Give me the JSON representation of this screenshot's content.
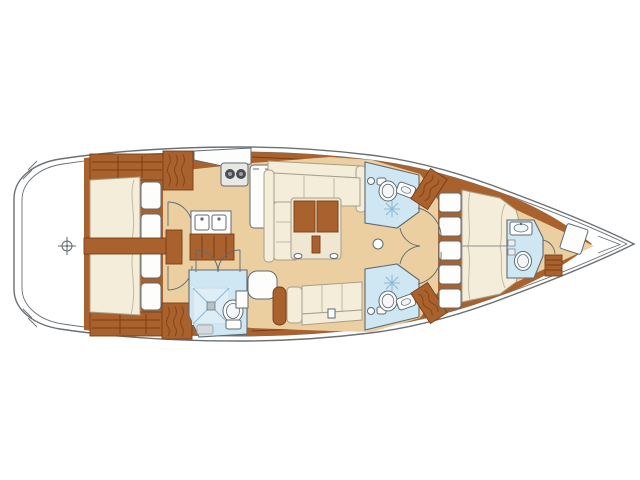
{
  "diagram": {
    "type": "yacht-interior-floor-plan",
    "view": "overhead-deck-plan",
    "orientation": "bow-right-stern-left",
    "rooms": [
      {
        "name": "transom-platform",
        "features": [
          "datum-crosshair-icon"
        ]
      },
      {
        "name": "aft-cabin-port",
        "features": [
          "double-berth",
          "pillow",
          "pillow",
          "shelf-unit",
          "hanging-locker",
          "door"
        ]
      },
      {
        "name": "aft-cabin-starboard",
        "features": [
          "double-berth",
          "pillow",
          "pillow",
          "shelf-unit",
          "hanging-locker",
          "door"
        ]
      },
      {
        "name": "galley",
        "features": [
          "counter",
          "two-burner-stove",
          "refrigerator",
          "double-sink",
          "cabinet"
        ]
      },
      {
        "name": "salon",
        "features": [
          "l-shaped-settee",
          "folding-table",
          "mast-post",
          "starboard-settee",
          "stool",
          "sideboard"
        ]
      },
      {
        "name": "aft-head",
        "features": [
          "shower-pan",
          "toilet",
          "vanity",
          "double-door",
          "mat"
        ]
      },
      {
        "name": "mid-head-port",
        "features": [
          "toilet",
          "sink",
          "shower-drain",
          "hanging-locker",
          "door"
        ]
      },
      {
        "name": "mid-head-starboard",
        "features": [
          "toilet",
          "sink",
          "shower-drain",
          "hanging-locker",
          "door"
        ]
      },
      {
        "name": "forward-cabin",
        "features": [
          "island-double-berth",
          "headboard-cushions-x5",
          "double-door"
        ]
      },
      {
        "name": "fore-head",
        "features": [
          "sink",
          "toilet",
          "door",
          "shelves"
        ]
      },
      {
        "name": "forepeak",
        "features": [
          "deck-hatch",
          "storage-box"
        ]
      }
    ],
    "counts": {
      "cabins": 3,
      "heads": 4,
      "aft-berth-pillows": 4,
      "forward-berth-cushions": 5
    }
  },
  "colors": {
    "hull": "#6b7075",
    "wood": "#a9622e",
    "wooddark": "#7a3d12",
    "woodlight": "#c58544",
    "tan": "#eccfa0",
    "cream": "#f3edda",
    "table": "#efe7d2",
    "white": "#fdfdfc",
    "blue": "#cfe7f3",
    "bluedark": "#8fb9d2",
    "fix": "#5f6a72",
    "uphol": "#a89f89",
    "squig": "#8a4619",
    "sheet": "#c2b9a5"
  }
}
